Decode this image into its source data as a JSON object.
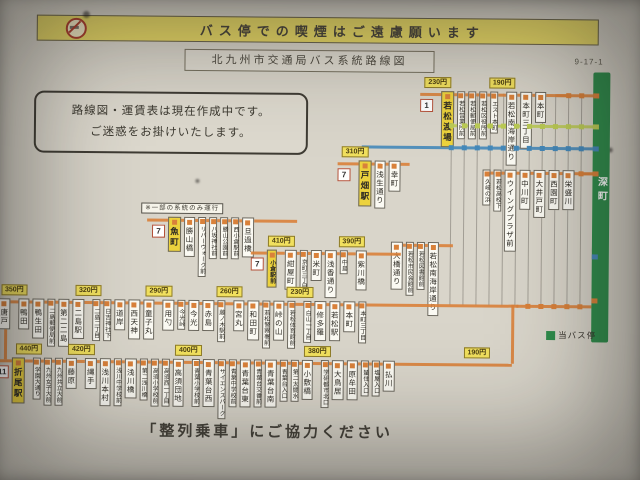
{
  "banner": {
    "text": "バス停での喫煙はご遠慮願います"
  },
  "title": {
    "text": "北九州市交通局バス系統路線図",
    "code": "9-17-1"
  },
  "notice": {
    "lines": [
      "路線図・運賃表は現在作成中です。",
      "ご迷惑をお掛けいたします。"
    ]
  },
  "footer": {
    "text": "「整列乗車」にご協力ください"
  },
  "legend": {
    "label": "当バス停"
  },
  "current_stop": {
    "name": "深町"
  },
  "colors": {
    "orange": "#d9813a",
    "yellowgreen": "#bccc55",
    "blue": "#4589ba",
    "green_bar": "#2f8d4c",
    "terminal_yellow": "#ecd23d",
    "fare_yellow": "#f1e05e"
  },
  "rows": [
    {
      "id": "wakato",
      "color": "orange",
      "items": [
        {
          "t": "badge",
          "label": "1"
        },
        {
          "t": "fare",
          "label": "230円"
        },
        {
          "t": "terminal",
          "label": "若松渡場"
        },
        {
          "t": "minor",
          "label": "若松営業所前"
        },
        {
          "t": "minor",
          "label": "若松郵便局前"
        },
        {
          "t": "minor",
          "label": "若松区役所前"
        },
        {
          "t": "minor",
          "label": "エスト本町"
        },
        {
          "t": "fare",
          "label": "190円"
        },
        {
          "t": "stop",
          "label": "若松南海岸通り"
        },
        {
          "t": "stop",
          "label": "本町三丁目"
        },
        {
          "t": "stop",
          "label": "本町"
        }
      ]
    },
    {
      "id": "tobata",
      "color": "orange",
      "items": [
        {
          "t": "badge",
          "label": "7"
        },
        {
          "t": "fare",
          "label": "310円"
        },
        {
          "t": "terminal",
          "label": "戸畑駅"
        },
        {
          "t": "stop",
          "label": "浅生通り"
        },
        {
          "t": "stop",
          "label": "幸町"
        }
      ]
    },
    {
      "id": "wakamatsu_east",
      "color": "orange",
      "items": [
        {
          "t": "minor",
          "label": "久岐の浜"
        },
        {
          "t": "minor",
          "label": "若松高校下"
        },
        {
          "t": "stop",
          "label": "ウイングプラザ前"
        },
        {
          "t": "stop",
          "label": "中川町"
        },
        {
          "t": "stop",
          "label": "大井戸町"
        },
        {
          "t": "stop",
          "label": "西園町"
        },
        {
          "t": "stop",
          "label": "栄盛川"
        }
      ]
    },
    {
      "id": "ohashi",
      "color": "orange",
      "items": [
        {
          "t": "stop",
          "label": "大橋通り"
        },
        {
          "t": "minor",
          "label": "若松市民会館前"
        },
        {
          "t": "minor",
          "label": "若松図書館前"
        },
        {
          "t": "stop",
          "label": "若松南海岸通り"
        }
      ]
    },
    {
      "id": "uomachi",
      "color": "orange",
      "items": [
        {
          "t": "note",
          "label": "※一部の系統のみ運行"
        },
        {
          "t": "badge",
          "label": "7"
        },
        {
          "t": "terminal",
          "label": "魚町"
        },
        {
          "t": "stop",
          "label": "勝山橋"
        },
        {
          "t": "minor",
          "label": "リバーウォーク前"
        },
        {
          "t": "minor",
          "label": "八坂神社前"
        },
        {
          "t": "minor",
          "label": "勝山公園前"
        },
        {
          "t": "minor",
          "label": "西小倉駅前"
        },
        {
          "t": "stop",
          "label": "旦過橋"
        }
      ]
    },
    {
      "id": "kokura",
      "color": "orange",
      "items": [
        {
          "t": "badge",
          "label": "7"
        },
        {
          "t": "terminal",
          "label": "小倉駅前",
          "small": true
        },
        {
          "t": "fare",
          "label": "410円"
        },
        {
          "t": "stop",
          "label": "紺屋町"
        },
        {
          "t": "minor",
          "label": "京町三丁目"
        },
        {
          "t": "stop",
          "label": "米町"
        },
        {
          "t": "stop",
          "label": "浅香通り"
        },
        {
          "t": "minor",
          "label": "中島"
        },
        {
          "t": "fare",
          "label": "390円"
        },
        {
          "t": "stop",
          "label": "紫川橋"
        }
      ]
    },
    {
      "id": "main",
      "color": "orange",
      "items": [
        {
          "t": "stop",
          "label": "唐戸"
        },
        {
          "t": "fare",
          "label": "350円"
        },
        {
          "t": "stop",
          "label": "鴨田"
        },
        {
          "t": "stop",
          "label": "鴨生田"
        },
        {
          "t": "minor",
          "label": "二島郵便局前"
        },
        {
          "t": "stop",
          "label": "第二二島"
        },
        {
          "t": "stop",
          "label": "二島駅"
        },
        {
          "t": "fare",
          "label": "320円"
        },
        {
          "t": "minor",
          "label": "二島二丁目"
        },
        {
          "t": "minor",
          "label": "日吉神社下"
        },
        {
          "t": "stop",
          "label": "道岸"
        },
        {
          "t": "stop",
          "label": "西天神"
        },
        {
          "t": "stop",
          "label": "童子丸"
        },
        {
          "t": "fare",
          "label": "290円"
        },
        {
          "t": "stop",
          "label": "用勺"
        },
        {
          "t": "minor",
          "label": "今光峠"
        },
        {
          "t": "stop",
          "label": "今光"
        },
        {
          "t": "stop",
          "label": "赤島"
        },
        {
          "t": "minor",
          "label": "藤ノ木駅前"
        },
        {
          "t": "fare",
          "label": "260円"
        },
        {
          "t": "stop",
          "label": "宮丸"
        },
        {
          "t": "stop",
          "label": "和田町"
        },
        {
          "t": "minor",
          "label": "若松警察署前"
        },
        {
          "t": "stop",
          "label": "峠の山"
        },
        {
          "t": "minor",
          "label": "若松体育館前"
        },
        {
          "t": "fare",
          "label": "230円"
        },
        {
          "t": "minor",
          "label": "白山一丁目"
        },
        {
          "t": "stop",
          "label": "修多羅"
        },
        {
          "t": "stop",
          "label": "若松駅"
        },
        {
          "t": "stop",
          "label": "本町"
        },
        {
          "t": "minor",
          "label": "本町三丁目"
        }
      ]
    },
    {
      "id": "orio",
      "color": "orange",
      "items": [
        {
          "t": "badge",
          "label": "11"
        },
        {
          "t": "terminal",
          "label": "折尾駅"
        },
        {
          "t": "fare",
          "label": "440円"
        },
        {
          "t": "minor",
          "label": "学園大通り"
        },
        {
          "t": "minor",
          "label": "九州女子大前"
        },
        {
          "t": "minor",
          "label": "九州共立大前"
        },
        {
          "t": "stop",
          "label": "藤原"
        },
        {
          "t": "fare",
          "label": "420円"
        },
        {
          "t": "stop",
          "label": "縄手"
        },
        {
          "t": "stop",
          "label": "浅川本村"
        },
        {
          "t": "minor",
          "label": "浅川中学校前"
        },
        {
          "t": "stop",
          "label": "浅川橋"
        },
        {
          "t": "minor",
          "label": "第二浅川橋"
        },
        {
          "t": "minor",
          "label": "高須小学校前"
        },
        {
          "t": "minor",
          "label": "高須西一丁目"
        },
        {
          "t": "stop",
          "label": "高須団地"
        },
        {
          "t": "fare",
          "label": "400円"
        },
        {
          "t": "minor",
          "label": "青葉小学校前"
        },
        {
          "t": "stop",
          "label": "青葉台西"
        },
        {
          "t": "minor",
          "label": "サイエンスパーク"
        },
        {
          "t": "minor",
          "label": "青葉中学校前"
        },
        {
          "t": "stop",
          "label": "青葉台東"
        },
        {
          "t": "minor",
          "label": "青葉台交番前"
        },
        {
          "t": "stop",
          "label": "青葉台南"
        },
        {
          "t": "minor",
          "label": "青葉台入口"
        },
        {
          "t": "minor",
          "label": "第二太閤水"
        },
        {
          "t": "stop",
          "label": "小敷橋"
        },
        {
          "t": "fare",
          "label": "380円"
        },
        {
          "t": "minor",
          "label": "学研都市北口"
        },
        {
          "t": "stop",
          "label": "大鳥居"
        },
        {
          "t": "stop",
          "label": "原牟田"
        },
        {
          "t": "minor",
          "label": "蜑住入口"
        },
        {
          "t": "minor",
          "label": "塩屋入口"
        },
        {
          "t": "stop",
          "label": "払川"
        },
        {
          "t": "fare",
          "label": "190円",
          "push": true
        }
      ]
    }
  ]
}
